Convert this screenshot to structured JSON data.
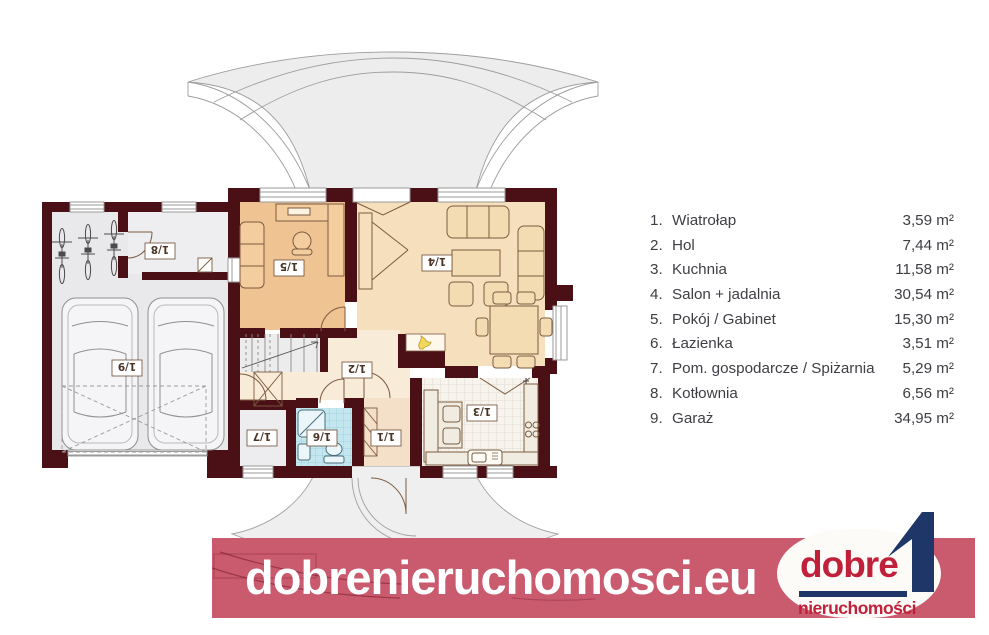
{
  "plan": {
    "rooms": {
      "r1": "1/1",
      "r2": "1/2",
      "r3": "1/3",
      "r4": "1/4",
      "r5": "1/5",
      "r6": "1/6",
      "r7": "1/7",
      "r8": "1/8",
      "r9": "1/9"
    }
  },
  "legend": {
    "items": [
      {
        "num": "1.",
        "name": "Wiatrołap",
        "area": "3,59 m²"
      },
      {
        "num": "2.",
        "name": "Hol",
        "area": "7,44 m²"
      },
      {
        "num": "3.",
        "name": "Kuchnia",
        "area": "11,58 m²"
      },
      {
        "num": "4.",
        "name": "Salon + jadalnia",
        "area": "30,54 m²"
      },
      {
        "num": "5.",
        "name": "Pokój / Gabinet",
        "area": "15,30 m²"
      },
      {
        "num": "6.",
        "name": "Łazienka",
        "area": "3,51 m²"
      },
      {
        "num": "7.",
        "name": "Pom. gospodarcze / Spiżarnia",
        "area": "5,29 m²"
      },
      {
        "num": "8.",
        "name": "Kotłownia",
        "area": "6,56 m²"
      },
      {
        "num": "9.",
        "name": "Garaż",
        "area": "34,95 m²"
      }
    ]
  },
  "banner": {
    "text": "dobrenieruchomosci.eu"
  },
  "logo": {
    "top": "dobre",
    "bottom": "nieruchomości"
  },
  "colors": {
    "wall": "#4b0f16",
    "banner": "#ca5a6e",
    "logo_red": "#c1203a",
    "logo_navy": "#1e3768",
    "room_office": "#f0c393",
    "room_salon": "#f6dfbc",
    "room_hall": "#f8ebd8",
    "room_entry": "#f4e0c8",
    "room_bath": "#c4e7ef",
    "room_garage": "#e9e9eb",
    "fireplace_flame": "#f0d95a"
  }
}
